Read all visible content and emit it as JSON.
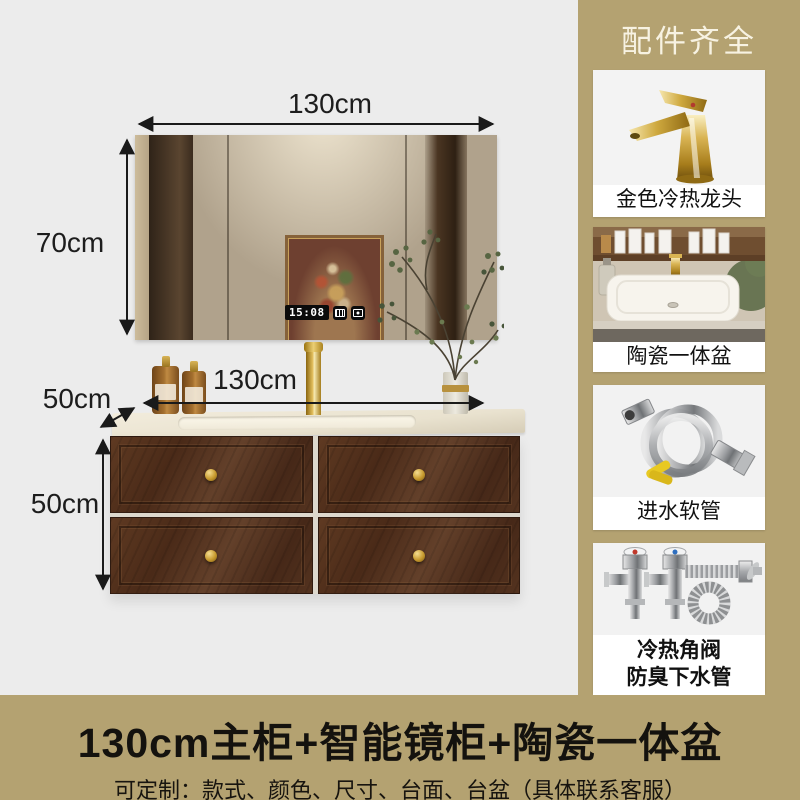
{
  "page": {
    "background": "#ececec",
    "accent": "#b4a271"
  },
  "sidebar": {
    "header": "配件齐全",
    "cards": [
      {
        "label": "金色冷热龙头",
        "image": "gold-faucet"
      },
      {
        "label": "陶瓷一体盆",
        "image": "ceramic-basin"
      },
      {
        "label": "进水软管",
        "image": "inlet-hose"
      },
      {
        "label": "冷热角阀",
        "label_line2": "防臭下水管",
        "image": "angle-valves-drain-pipe"
      }
    ]
  },
  "diagram": {
    "mirror_width": "130cm",
    "mirror_height": "70cm",
    "counter_depth": "50cm",
    "counter_width": "130cm",
    "cabinet_height": "50cm",
    "mirror_clock_time": "15:08"
  },
  "banner": {
    "title": "130cm主柜+智能镜柜+陶瓷一体盆",
    "subtitle": "可定制：款式、颜色、尺寸、台面、台盆（具体联系客服）"
  }
}
